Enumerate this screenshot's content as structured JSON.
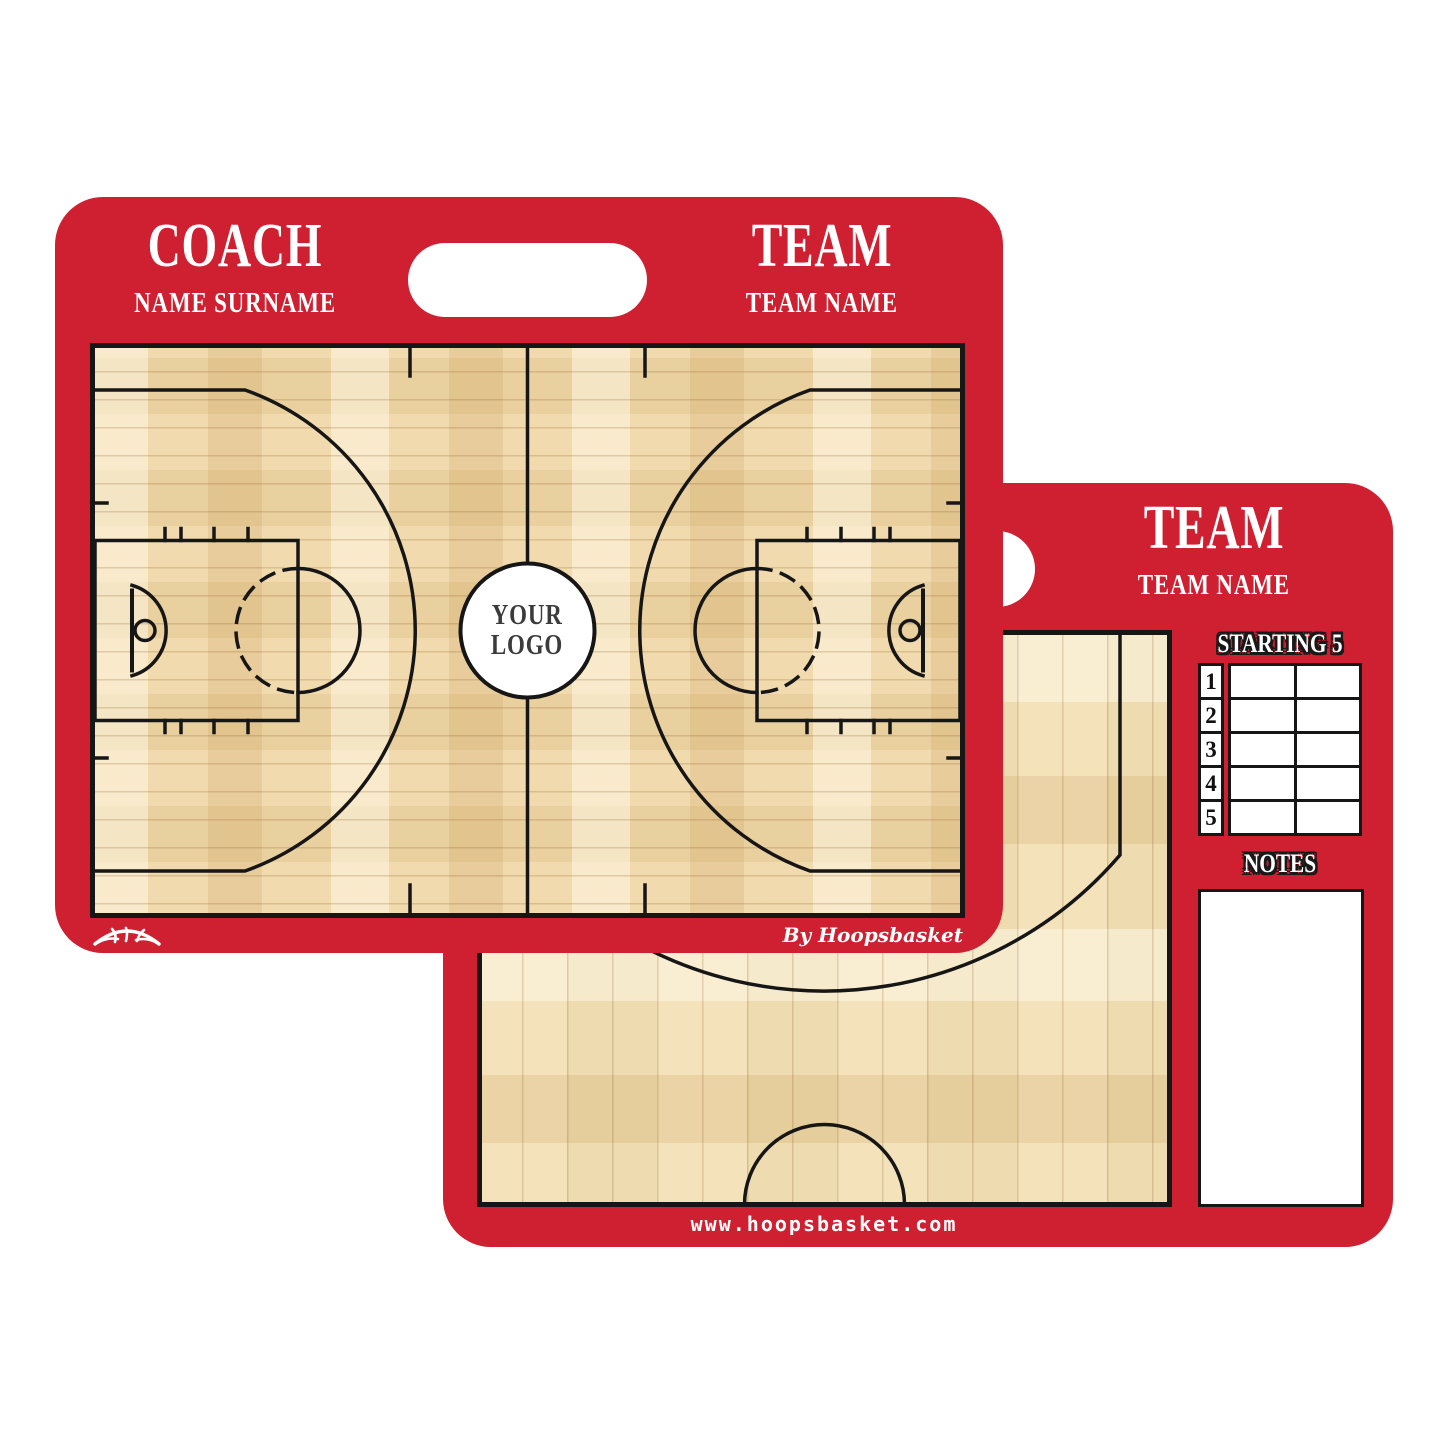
{
  "colors": {
    "board_red": "#CE2031",
    "court_line": "#161616",
    "wood_front": "#EFD5A3",
    "wood_back": "#F3DFB3",
    "text_white": "#FFFFFF"
  },
  "front_board": {
    "coach_label": "COACH",
    "coach_name": "NAME SURNAME",
    "team_label": "TEAM",
    "team_name": "TEAM NAME",
    "center_logo": {
      "line1": "YOUR",
      "line2": "LOGO"
    },
    "credit": "By Hoopsbasket",
    "icons": {
      "ball_logo": "basketball-swoosh-icon"
    }
  },
  "back_board": {
    "team_label": "TEAM",
    "team_name": "TEAM NAME",
    "starting_five": {
      "title": "STARTING 5",
      "rows": [
        {
          "number": "1",
          "col1": "",
          "col2": ""
        },
        {
          "number": "2",
          "col1": "",
          "col2": ""
        },
        {
          "number": "3",
          "col1": "",
          "col2": ""
        },
        {
          "number": "4",
          "col1": "",
          "col2": ""
        },
        {
          "number": "5",
          "col1": "",
          "col2": ""
        }
      ]
    },
    "notes_title": "NOTES",
    "website": "www.hoopsbasket.com"
  }
}
